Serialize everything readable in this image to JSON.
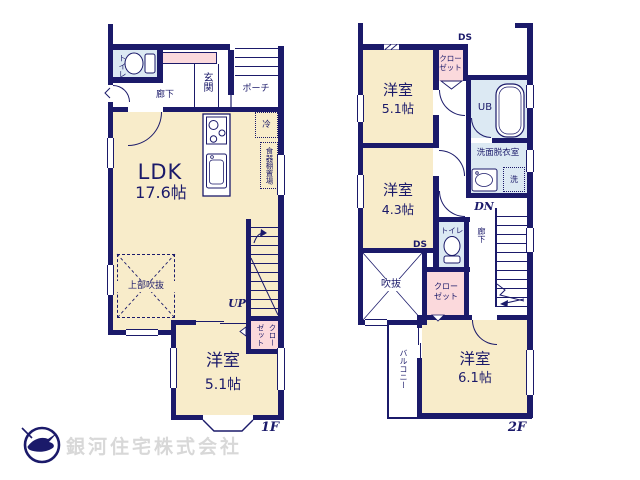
{
  "colors": {
    "wall_navy": "#1b1a6a",
    "room_cream": "#f8ecca",
    "wet_blue": "#dce9f3",
    "closet_pink": "#fbd9dc",
    "logo_text_gray": "#d8d8d8"
  },
  "floor1": {
    "floor_label": "1F",
    "labels": {
      "toilet": "トイレ",
      "corridor": "廊下",
      "entrance": "玄関",
      "porch": "ポーチ",
      "ldk_name": "LDK",
      "ldk_area": "17.6帖",
      "fridge": "冷",
      "cupboard": "食器棚置場",
      "upper_void": "上部吹抜",
      "up": "UP",
      "closet": "クローゼット",
      "room_name": "洋室",
      "room_area": "5.1帖"
    }
  },
  "floor2": {
    "floor_label": "2F",
    "labels": {
      "ds_top": "DS",
      "ds_mid": "DS",
      "room51_name": "洋室",
      "room51_area": "5.1帖",
      "closet_top": "クローゼット",
      "ub": "UB",
      "washroom": "洗面脱衣室",
      "washer": "洗",
      "room43_name": "洋室",
      "room43_area": "4.3帖",
      "toilet": "トイレ",
      "dn": "DN",
      "corridor": "廊下",
      "void": "吹抜",
      "closet_mid": "クローゼット",
      "balcony": "バルコニー",
      "room61_name": "洋室",
      "room61_area": "6.1帖"
    }
  },
  "footer": {
    "company": "銀河住宅株式会社"
  }
}
